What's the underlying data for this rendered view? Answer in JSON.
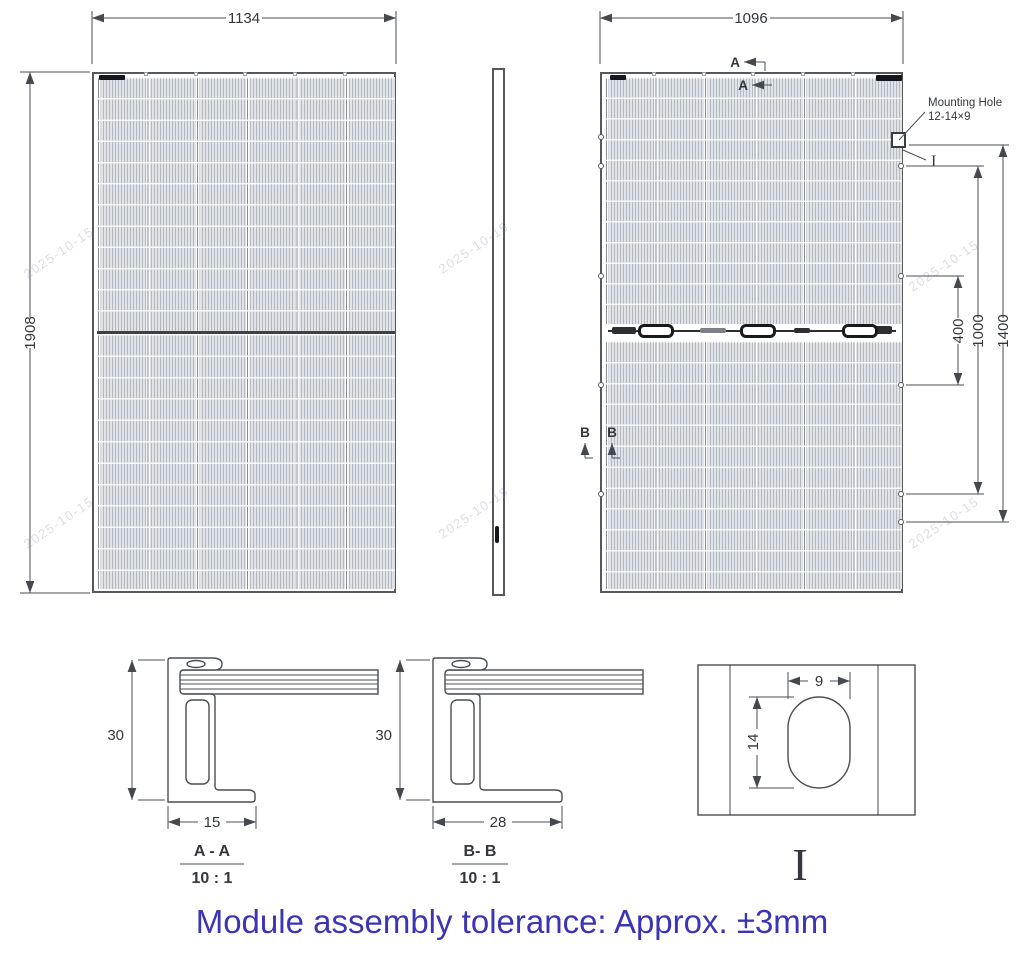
{
  "watermark": {
    "text": "2025-10-15"
  },
  "front_view": {
    "width_dim": "1134",
    "height_dim": "1908"
  },
  "back_view": {
    "width_dim": "1096",
    "section_a": "A",
    "section_b": "B",
    "dim_mid": "400",
    "dim_inner": "1000",
    "dim_outer": "1400",
    "mounting_hole_title": "Mounting Hole",
    "mounting_hole_size": "12-14×9",
    "detail_ref": "I"
  },
  "section_aa": {
    "title": "A - A",
    "scale": "10 : 1",
    "height_dim": "30",
    "width_dim": "15"
  },
  "section_bb": {
    "title": "B- B",
    "scale": "10 : 1",
    "height_dim": "30",
    "width_dim": "28"
  },
  "detail_i": {
    "width_dim": "9",
    "height_dim": "14",
    "label": "I"
  },
  "footer": {
    "note": "Module assembly tolerance: Approx. ±3mm"
  }
}
